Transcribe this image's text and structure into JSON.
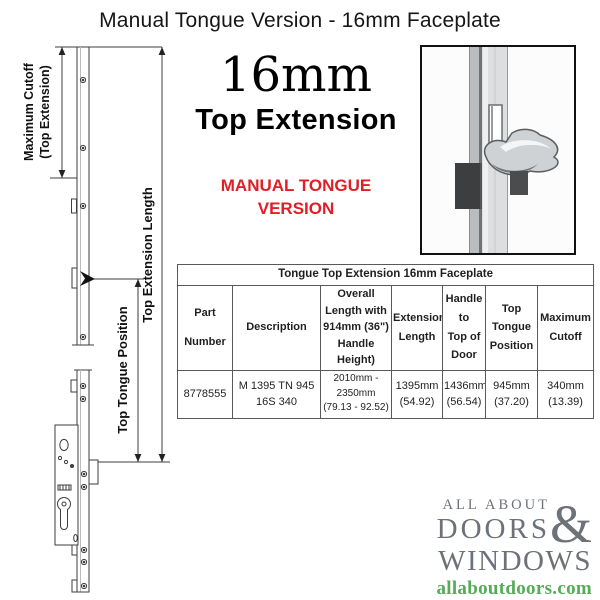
{
  "page": {
    "title": "Manual Tongue Version - 16mm Faceplate"
  },
  "hero": {
    "size": "16mm",
    "name": "Top Extension",
    "variant_line1": "MANUAL TONGUE",
    "variant_line2": "VERSION"
  },
  "diagram": {
    "label_max_cutoff_line1": "Maximum Cutoff",
    "label_max_cutoff_line2": "(Top Extension)",
    "label_extension_length": "Top Extension Length",
    "label_tongue_position": "Top Tongue Position"
  },
  "table": {
    "title": "Tongue Top  Extension 16mm Faceplate",
    "headers": [
      "Part\nNumber",
      "Description",
      "Overall\nLength with\n914mm (36\")\nHandle\nHeight)",
      "Extension\nLength",
      "Handle\nto\nTop of\nDoor",
      "Top\nTongue\nPosition",
      "Maximum\nCutoff"
    ],
    "row": [
      "8778555",
      "M 1395 TN 945\n16S 340",
      "2010mm -\n2350mm\n(79.13 - 92.52)",
      "1395mm\n(54.92)",
      "1436mm\n(56.54)",
      "945mm\n(37.20)",
      "340mm\n(13.39)"
    ]
  },
  "logo": {
    "line1": "ALL ABOUT",
    "line2": "DOORS",
    "ampersand": "&",
    "line3": "WINDOWS",
    "url": "allaboutdoors.com"
  },
  "colors": {
    "accent_red": "#e01e25",
    "logo_gray": "#6d7278",
    "logo_green": "#56ab59",
    "table_border": "#595959"
  }
}
